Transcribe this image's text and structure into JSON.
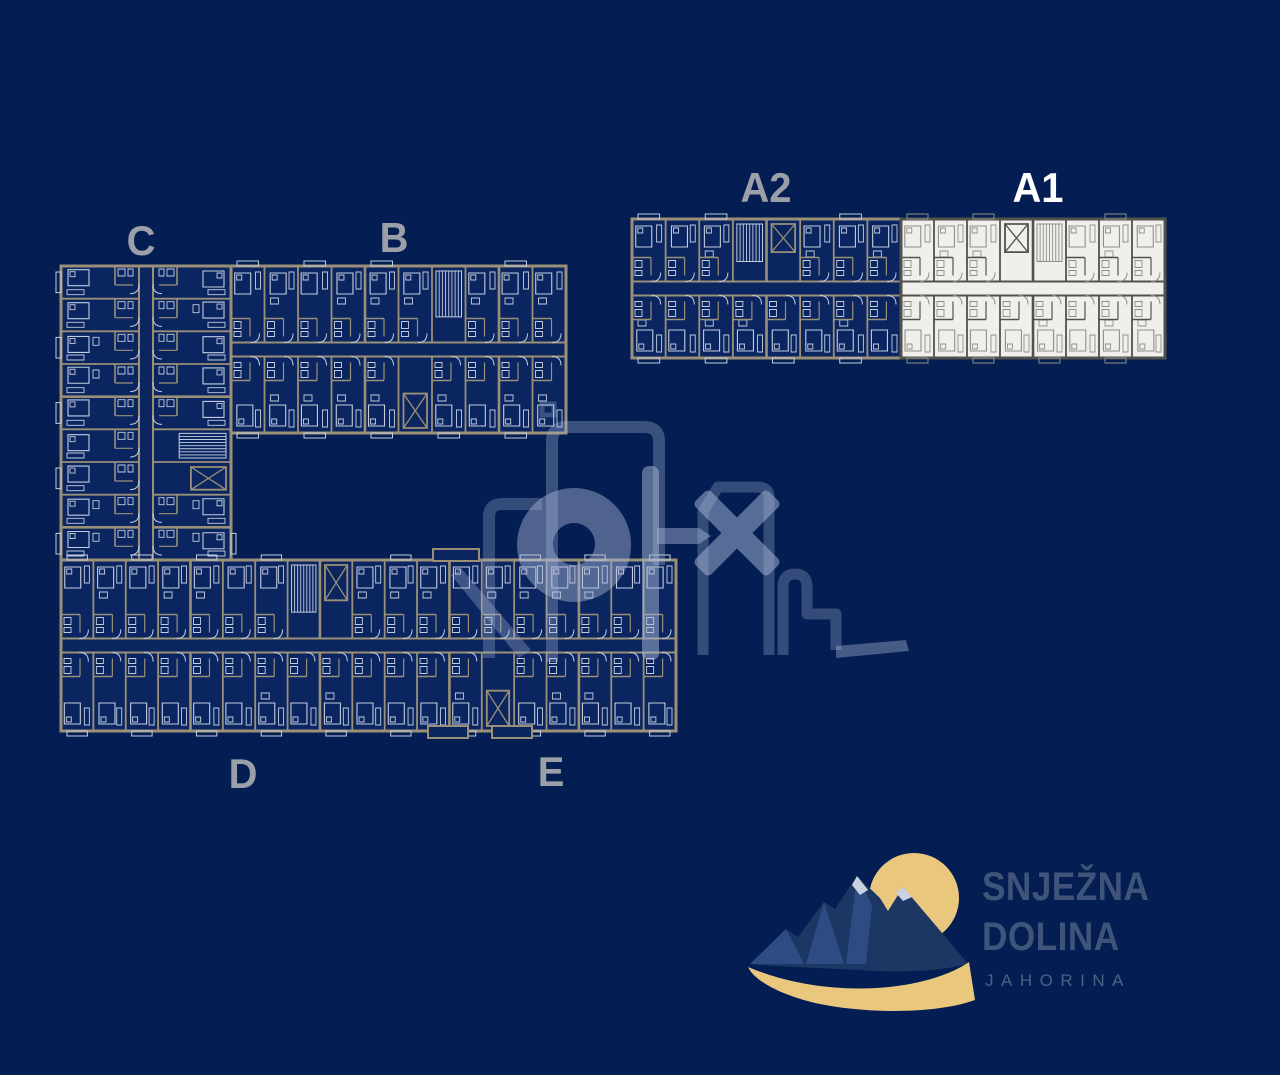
{
  "page": {
    "background": "#041e53",
    "description": "Snježna Dolina Jahorina residential complex floor plan overview"
  },
  "buildings": {
    "c": {
      "label": "C",
      "highlighted": false
    },
    "b": {
      "label": "B",
      "highlighted": false
    },
    "a2": {
      "label": "A2",
      "highlighted": false
    },
    "a1": {
      "label": "A1",
      "highlighted": true
    },
    "d": {
      "label": "D",
      "highlighted": false
    },
    "e": {
      "label": "E",
      "highlighted": false
    }
  },
  "watermark": {
    "name": "olx"
  },
  "logo": {
    "title_line1": "SNJEŽNA",
    "title_line2": "DOLINA",
    "subtitle": "JAHORINA"
  },
  "colors": {
    "background": "#041e53",
    "plan_dark_wall": "#9a9078",
    "plan_dark_line": "#c3cddd",
    "plan_dark_fill": "#0b2560",
    "plan_light_wall": "#52524d",
    "plan_light_line": "#8f8f8a",
    "plan_light_fill": "#f0efec",
    "label": "#9ba0a8",
    "label_highlight": "#ffffff",
    "watermark": "#aab9d8",
    "logo_gold": "#e9c87e",
    "logo_mountain": "#1d3765",
    "logo_mountain_light": "#2e4c83",
    "logo_snow": "#c9d2e0",
    "logo_text": "#3f5478",
    "logo_subtext": "#4d6183"
  }
}
